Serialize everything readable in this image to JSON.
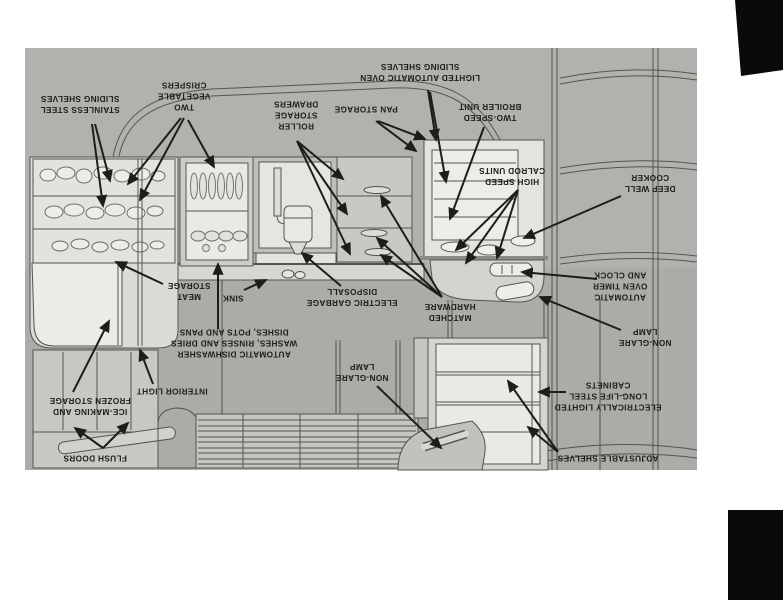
{
  "photo": {
    "description_orientation": "upside-down",
    "colors": {
      "page_bg": "#ffffff",
      "photo_bg": "#b2b1ad",
      "wall_shade": "#acaba7",
      "cabinet_light": "#eae9e5",
      "cabinet_mid": "#d5d4d0",
      "cabinet_dark": "#c6c5c1",
      "line": "#55544f",
      "ink": "#1d1d1b",
      "scan_mark": "#0a0a0a"
    }
  },
  "diagram": {
    "labels": [
      {
        "id": "stainless-steel-sliding-shelves",
        "x": 80,
        "y": 104,
        "lines": [
          "STAINLESS STEEL",
          "SLIDING SHELVES"
        ]
      },
      {
        "id": "two-vegetable-crispers",
        "x": 184,
        "y": 96,
        "lines": [
          "TWO",
          "VEGETABLE",
          "CRISPERS"
        ]
      },
      {
        "id": "roller-storage-drawers",
        "x": 296,
        "y": 115,
        "lines": [
          "ROLLER",
          "STORAGE",
          "DRAWERS"
        ]
      },
      {
        "id": "pan-storage",
        "x": 366,
        "y": 109,
        "lines": [
          "PAN STORAGE"
        ]
      },
      {
        "id": "lighted-automatic-oven",
        "x": 420,
        "y": 72,
        "lines": [
          "LIGHTED AUTOMATIC OVEN",
          "SLIDING SHELVES"
        ]
      },
      {
        "id": "two-speed-broiler-unit",
        "x": 490,
        "y": 112,
        "lines": [
          "TWO-SPEED",
          "BROILER UNIT"
        ]
      },
      {
        "id": "high-speed-calrod-units",
        "x": 512,
        "y": 176,
        "lines": [
          "HIGH SPEED",
          "CALROD UNITS"
        ]
      },
      {
        "id": "deep-well-cooker",
        "x": 650,
        "y": 183,
        "lines": [
          "DEEP WELL",
          "COOKER"
        ]
      },
      {
        "id": "automatic-oven-timer",
        "x": 620,
        "y": 286,
        "lines": [
          "AUTOMATIC",
          "OVEN TIMER",
          "AND CLOCK"
        ]
      },
      {
        "id": "non-glare-lamp-right",
        "x": 645,
        "y": 337,
        "lines": [
          "NON-GLARE",
          "LAMP"
        ]
      },
      {
        "id": "electrically-lighted-cabinets",
        "x": 608,
        "y": 396,
        "lines": [
          "ELECTRICALLY LIGHTED",
          "LONG-LIFE STEEL",
          "CABINETS"
        ]
      },
      {
        "id": "adjustable-shelves",
        "x": 608,
        "y": 458,
        "lines": [
          "ADJUSTABLE SHELVES"
        ]
      },
      {
        "id": "matched-hardware",
        "x": 450,
        "y": 312,
        "lines": [
          "MATCHED",
          "HARDWARE"
        ]
      },
      {
        "id": "electric-garbage-disposall",
        "x": 352,
        "y": 297,
        "lines": [
          "ELECTRIC GARBAGE",
          "DISPOSALL"
        ]
      },
      {
        "id": "sink",
        "x": 233,
        "y": 298,
        "lines": [
          "SINK"
        ]
      },
      {
        "id": "meat-storage",
        "x": 189,
        "y": 291,
        "lines": [
          "MEAT",
          "STORAGE"
        ]
      },
      {
        "id": "automatic-dishwasher",
        "x": 234,
        "y": 343,
        "lines": [
          "AUTOMATIC DISHWASHER",
          "WASHES, RINSES AND DRIES",
          "DISHES, POTS AND PANS"
        ]
      },
      {
        "id": "interior-light",
        "x": 172,
        "y": 391,
        "lines": [
          "INTERIOR LIGHT"
        ]
      },
      {
        "id": "non-glare-lamp-bottom",
        "x": 362,
        "y": 372,
        "lines": [
          "NON-GLARE",
          "LAMP"
        ]
      },
      {
        "id": "ice-making-frozen-storage",
        "x": 90,
        "y": 406,
        "lines": [
          "ICE-MAKING AND",
          "FROZEN STORAGE"
        ]
      },
      {
        "id": "flush-doors",
        "x": 95,
        "y": 458,
        "lines": [
          "FLUSH DOORS"
        ]
      }
    ],
    "arrows": [
      {
        "label": "stainless-steel-sliding-shelves",
        "x1": 95,
        "y1": 124,
        "x2": 110,
        "y2": 181
      },
      {
        "label": "stainless-steel-sliding-shelves",
        "x1": 92,
        "y1": 124,
        "x2": 103,
        "y2": 206
      },
      {
        "label": "two-vegetable-crispers",
        "x1": 181,
        "y1": 118,
        "x2": 128,
        "y2": 184
      },
      {
        "label": "two-vegetable-crispers",
        "x1": 184,
        "y1": 118,
        "x2": 140,
        "y2": 200
      },
      {
        "label": "two-vegetable-crispers",
        "x1": 188,
        "y1": 120,
        "x2": 214,
        "y2": 167
      },
      {
        "label": "roller-storage-drawers",
        "x1": 297,
        "y1": 141,
        "x2": 343,
        "y2": 179
      },
      {
        "label": "roller-storage-drawers",
        "x1": 297,
        "y1": 141,
        "x2": 347,
        "y2": 214
      },
      {
        "label": "roller-storage-drawers",
        "x1": 297,
        "y1": 141,
        "x2": 350,
        "y2": 254
      },
      {
        "label": "pan-storage",
        "x1": 378,
        "y1": 121,
        "x2": 425,
        "y2": 139
      },
      {
        "label": "pan-storage",
        "x1": 376,
        "y1": 121,
        "x2": 416,
        "y2": 151
      },
      {
        "label": "lighted-automatic-oven",
        "x1": 428,
        "y1": 90,
        "x2": 436,
        "y2": 140
      },
      {
        "label": "lighted-automatic-oven",
        "x1": 430,
        "y1": 92,
        "x2": 446,
        "y2": 182
      },
      {
        "label": "two-speed-broiler-unit",
        "x1": 484,
        "y1": 127,
        "x2": 450,
        "y2": 219
      },
      {
        "label": "high-speed-calrod-units",
        "x1": 518,
        "y1": 190,
        "x2": 456,
        "y2": 250
      },
      {
        "label": "high-speed-calrod-units",
        "x1": 518,
        "y1": 190,
        "x2": 466,
        "y2": 263
      },
      {
        "label": "high-speed-calrod-units",
        "x1": 518,
        "y1": 190,
        "x2": 497,
        "y2": 258
      },
      {
        "label": "deep-well-cooker",
        "x1": 621,
        "y1": 196,
        "x2": 524,
        "y2": 238
      },
      {
        "label": "automatic-oven-timer",
        "x1": 597,
        "y1": 279,
        "x2": 522,
        "y2": 272
      },
      {
        "label": "non-glare-lamp-right",
        "x1": 621,
        "y1": 330,
        "x2": 540,
        "y2": 297
      },
      {
        "label": "electrically-lighted-cabinets",
        "x1": 566,
        "y1": 392,
        "x2": 539,
        "y2": 392
      },
      {
        "label": "adjustable-shelves",
        "x1": 558,
        "y1": 452,
        "x2": 508,
        "y2": 381
      },
      {
        "label": "adjustable-shelves",
        "x1": 558,
        "y1": 452,
        "x2": 528,
        "y2": 427
      },
      {
        "label": "matched-hardware",
        "x1": 442,
        "y1": 297,
        "x2": 381,
        "y2": 196
      },
      {
        "label": "matched-hardware",
        "x1": 442,
        "y1": 297,
        "x2": 377,
        "y2": 238
      },
      {
        "label": "matched-hardware",
        "x1": 442,
        "y1": 297,
        "x2": 381,
        "y2": 255
      },
      {
        "label": "electric-garbage-disposall",
        "x1": 341,
        "y1": 286,
        "x2": 302,
        "y2": 253
      },
      {
        "label": "sink",
        "x1": 244,
        "y1": 290,
        "x2": 266,
        "y2": 280
      },
      {
        "label": "meat-storage",
        "x1": 163,
        "y1": 284,
        "x2": 116,
        "y2": 262
      },
      {
        "label": "automatic-dishwasher",
        "x1": 218,
        "y1": 329,
        "x2": 218,
        "y2": 264
      },
      {
        "label": "interior-light",
        "x1": 153,
        "y1": 384,
        "x2": 140,
        "y2": 350
      },
      {
        "label": "non-glare-lamp-bottom",
        "x1": 377,
        "y1": 386,
        "x2": 441,
        "y2": 448
      },
      {
        "label": "ice-making-frozen-storage",
        "x1": 73,
        "y1": 392,
        "x2": 109,
        "y2": 321
      },
      {
        "label": "flush-doors",
        "x1": 103,
        "y1": 448,
        "x2": 75,
        "y2": 428
      },
      {
        "label": "flush-doors",
        "x1": 103,
        "y1": 448,
        "x2": 128,
        "y2": 423
      }
    ]
  }
}
